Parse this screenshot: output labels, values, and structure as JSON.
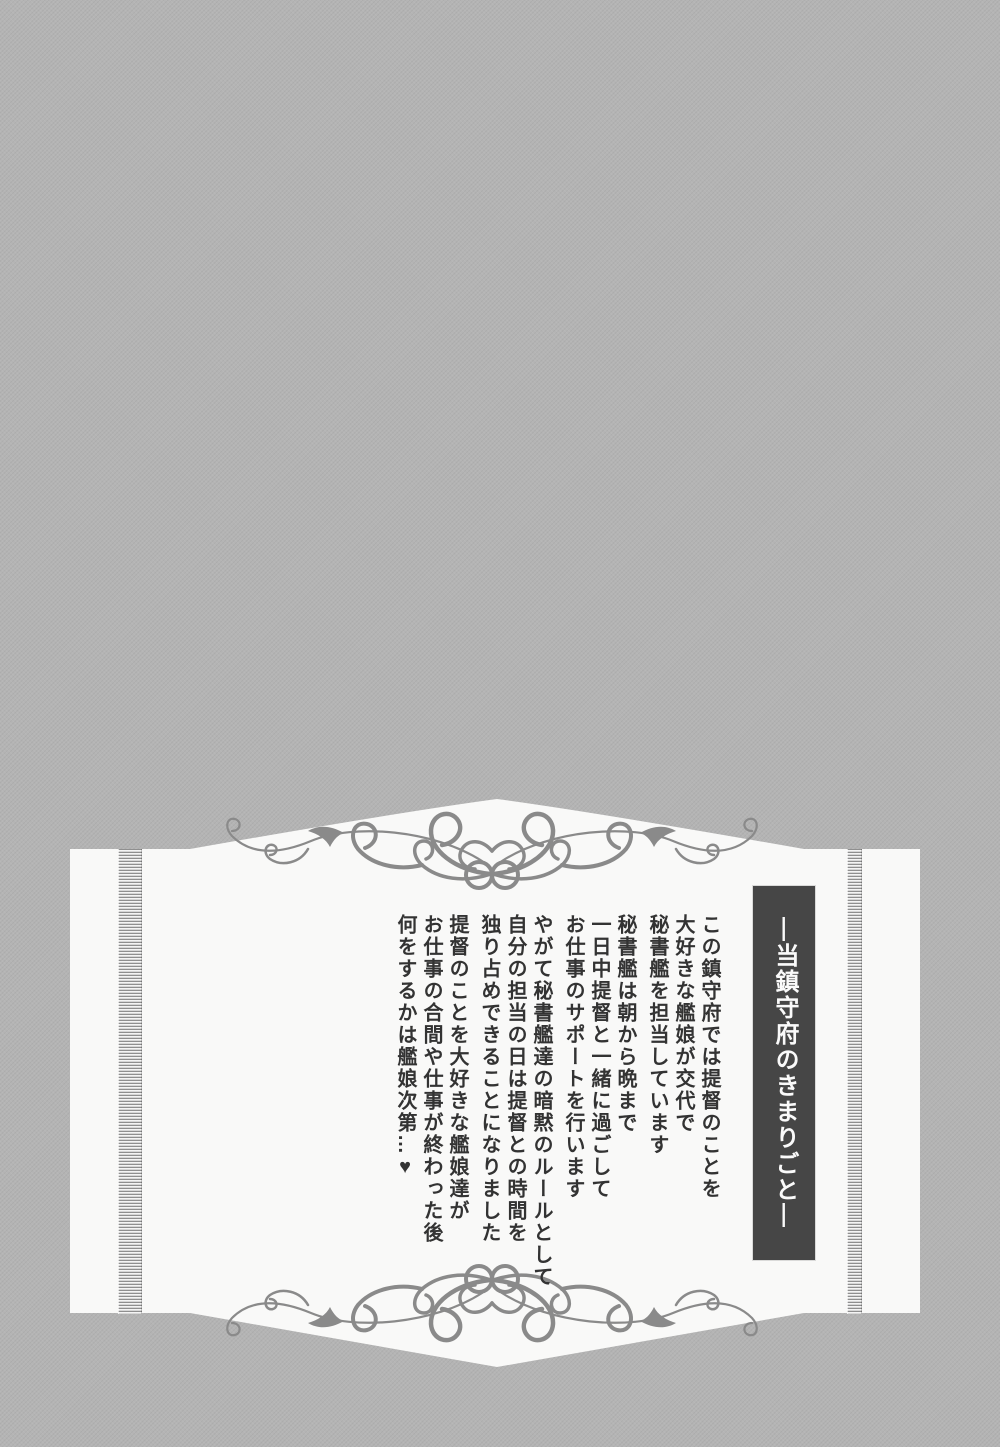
{
  "colors": {
    "page_bg": "#b4b4b4",
    "panel_bg": "#f9f9f8",
    "ornament": "#8a8a8a",
    "bar_bg": "#464646",
    "bar_text": "#fafafa",
    "body_text": "#333333"
  },
  "panel": {
    "title": "―当鎮守府のきまりごと―",
    "paragraphs": [
      {
        "lines": [
          "この鎮守府では提督のことを",
          "大好きな艦娘が交代で",
          "秘書艦を担当しています"
        ]
      },
      {
        "lines": [
          "秘書艦は朝から晩まで",
          "一日中提督と一緒に過ごして",
          "お仕事のサポートを行います"
        ]
      },
      {
        "lines": [
          "やがて秘書艦達の暗黙のルールとして",
          "自分の担当の日は提督との時間を",
          "独り占めできることになりました"
        ]
      },
      {
        "lines": [
          "提督のことを大好きな艦娘達が",
          "お仕事の合間や仕事が終わった後",
          "何をするかは艦娘次第…♥"
        ]
      }
    ]
  }
}
